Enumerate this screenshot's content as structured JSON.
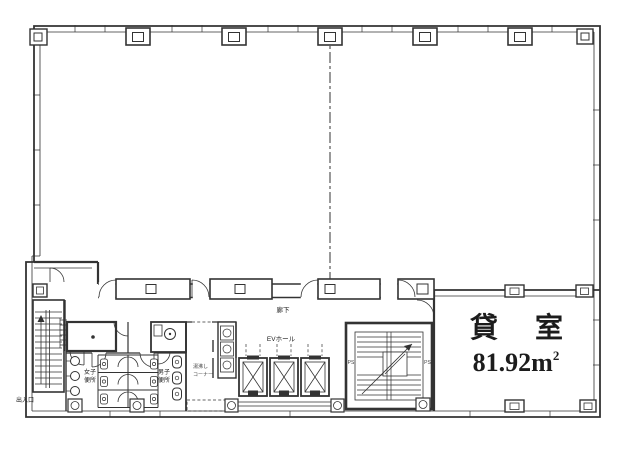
{
  "document": {
    "type": "architectural-floor-plan",
    "colors": {
      "ink": "#333333",
      "paper": "#ffffff",
      "text": "#1c1c1c"
    }
  },
  "labels": {
    "rental_room_name": "貸 室",
    "rental_room_area": "81.92m",
    "rental_room_area_sup": "2",
    "corridor": "廊下",
    "ev_hall": "EVホール",
    "womens_toilet_line1": "女子",
    "womens_toilet_line2": "便所",
    "mens_toilet_line1": "男子",
    "mens_toilet_line2": "便所",
    "kitchenette_line1": "湯沸し",
    "kitchenette_line2": "コーナー",
    "entrance": "出入口",
    "pipe_space_left": "PS",
    "pipe_space_right": "PS"
  }
}
